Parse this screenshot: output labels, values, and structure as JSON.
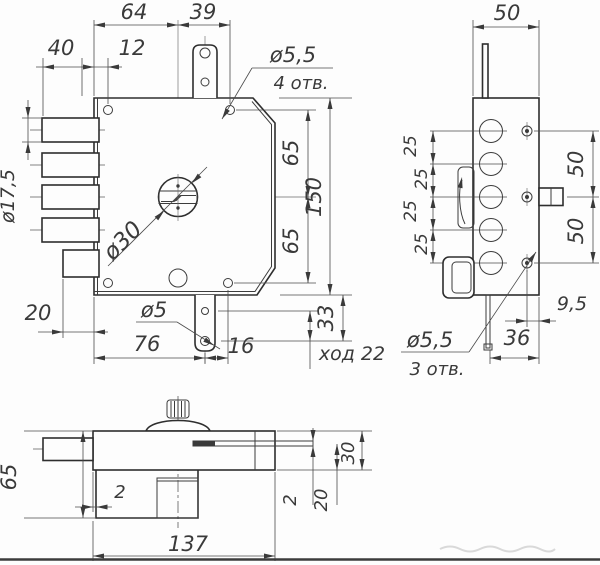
{
  "front_view": {
    "dim_64": "64",
    "dim_39": "39",
    "dim_40": "40",
    "dim_12": "12",
    "hole_note_top": {
      "diameter": "ø5,5",
      "count": "4 отв."
    },
    "dim_65_upper": "65",
    "dim_65_lower": "65",
    "dim_150": "150",
    "dim_33": "33",
    "dim_stroke": "ход 22",
    "dim_bolt_diameter": "ø17,5",
    "dim_20": "20",
    "dim_76": "76",
    "dim_16": "16",
    "hole_note_bottom": "ø5",
    "dim_keyhole": "ø30"
  },
  "side_view": {
    "dim_50_width": "50",
    "pitch_dims": [
      "25",
      "25",
      "25",
      "25"
    ],
    "dim_50_upper": "50",
    "dim_50_lower": "50",
    "dim_9_5": "9,5",
    "dim_36": "36",
    "hole_note": {
      "diameter": "ø5,5",
      "count": "3 отв."
    }
  },
  "bottom_view": {
    "dim_65": "65",
    "dim_2_left": "2",
    "dim_137": "137",
    "dim_2_right": "2",
    "dim_20": "20",
    "dim_30": "30"
  }
}
